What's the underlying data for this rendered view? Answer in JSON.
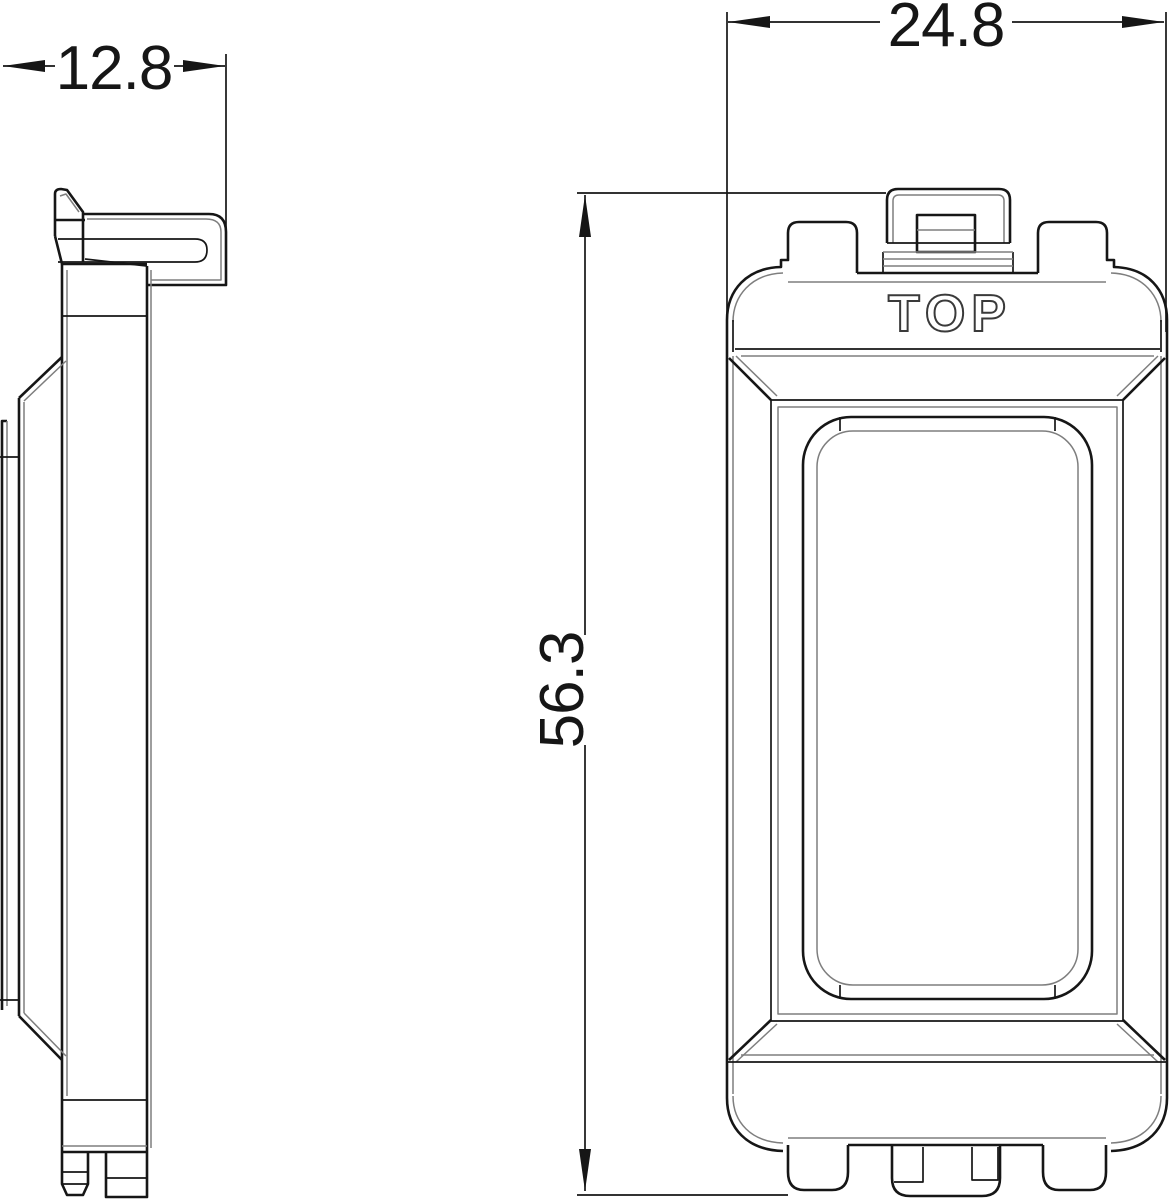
{
  "drawing": {
    "marking": "TOP",
    "dimensions": {
      "depth": "12.8",
      "width": "24.8",
      "height": "56.3"
    },
    "colors": {
      "line": "#161616",
      "secondary": "#7e7e7e",
      "marking_outline": "#3a3a3a",
      "background": "#ffffff"
    }
  }
}
